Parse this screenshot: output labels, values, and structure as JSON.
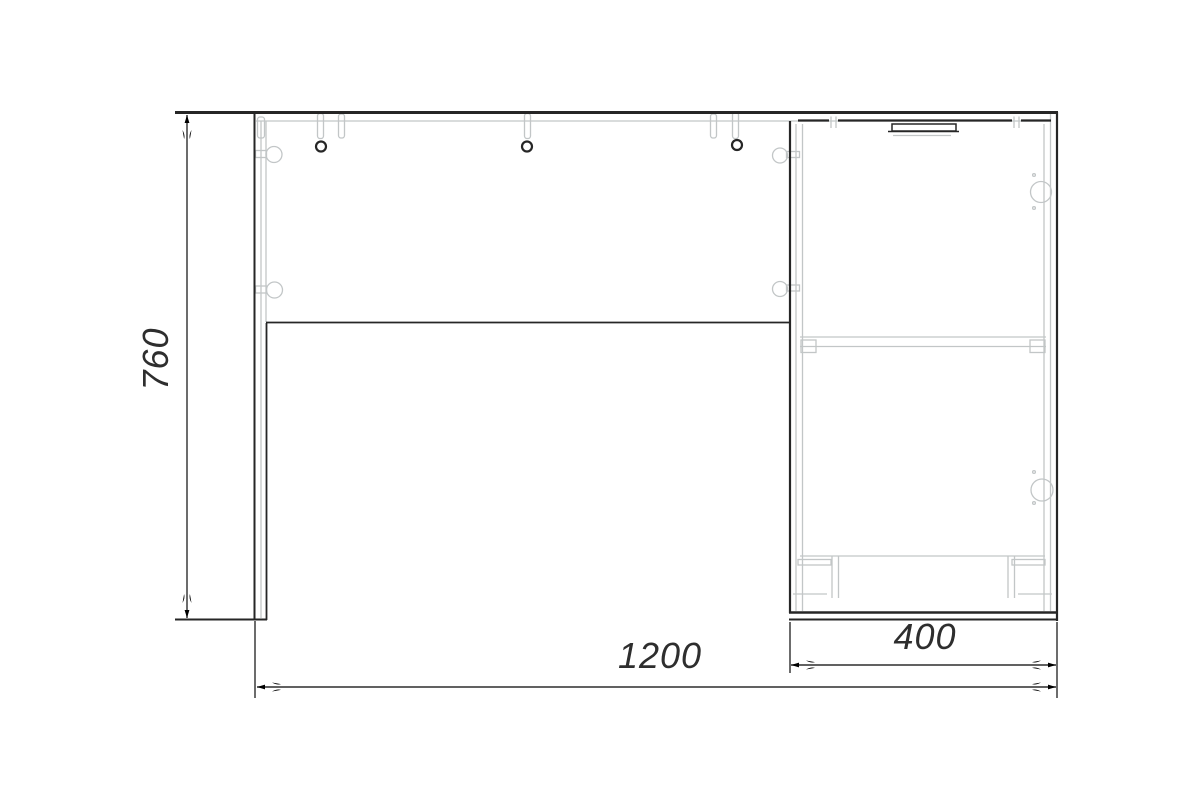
{
  "drawing": {
    "type": "furniture-front-elevation-desk-with-cabinet",
    "dimensions": {
      "height_label": "760",
      "width_label": "1200",
      "depth_label": "400"
    },
    "colors": {
      "outline_dark": "#262626",
      "hidden_line_gray": "#c2c6c7",
      "dimension_line": "#2d2d2d",
      "background": "#ffffff"
    }
  }
}
